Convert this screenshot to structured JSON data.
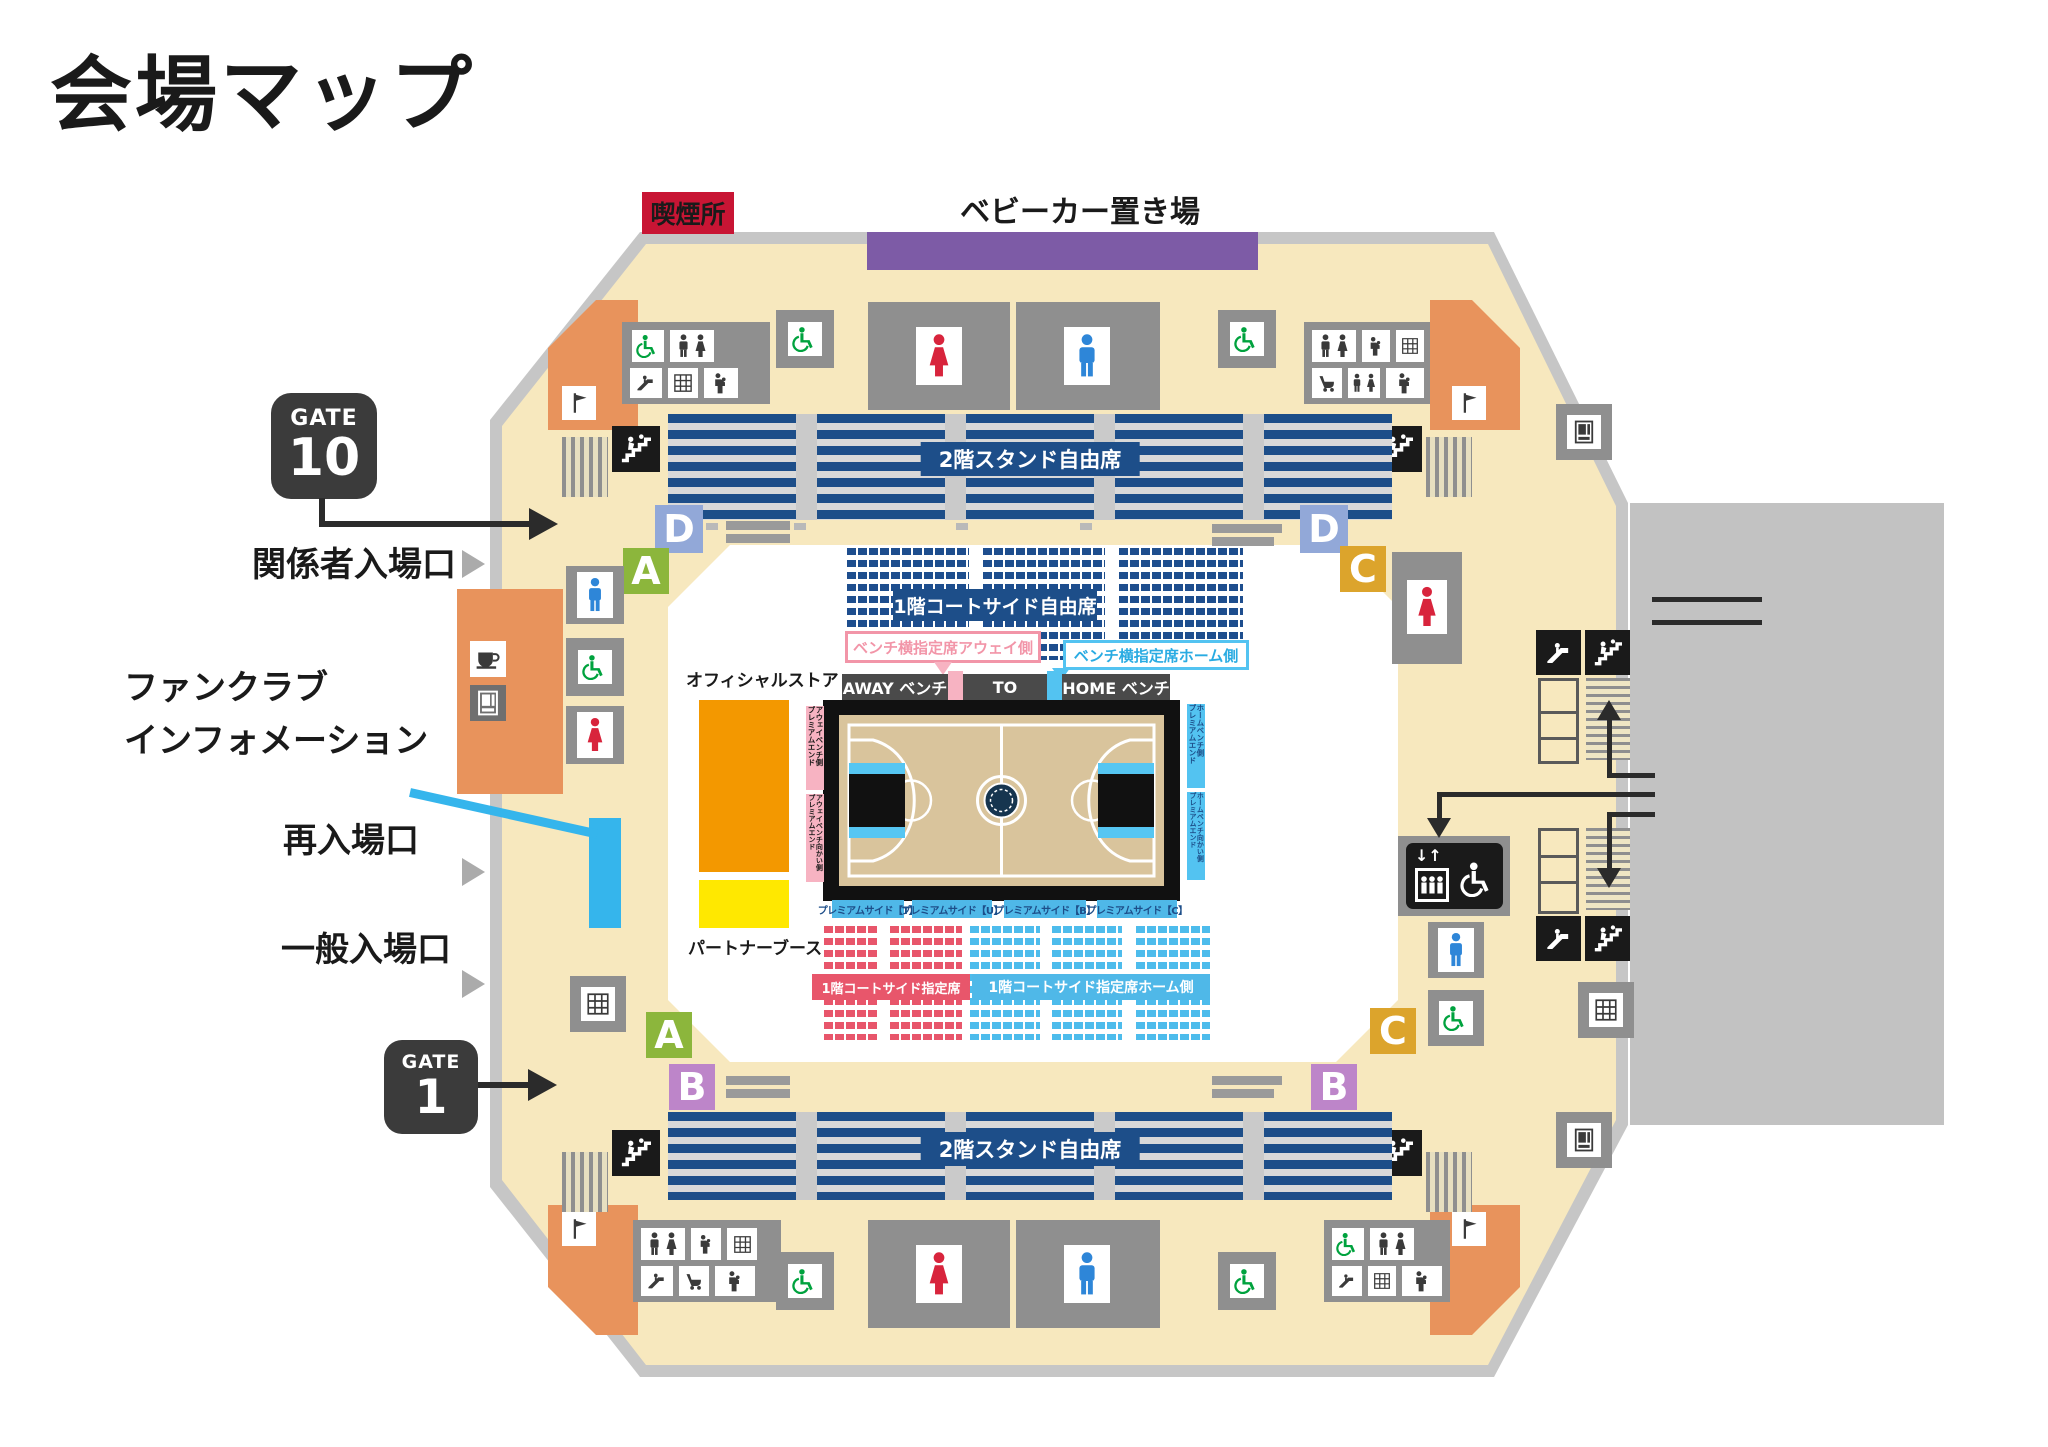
{
  "title": "会場マップ",
  "top": {
    "smoking": "喫煙所",
    "stroller": "ベビーカー置き場"
  },
  "gates": {
    "g10_prefix": "GATE",
    "g10_number": "10",
    "g1_prefix": "GATE",
    "g1_number": "1"
  },
  "entrances": {
    "staff": "関係者入場口",
    "fanclub_l1": "ファンクラブ",
    "fanclub_l2": "インフォメーション",
    "reentry": "再入場口",
    "general": "一般入場口"
  },
  "stands": {
    "stand_2f": "2階スタンド自由席",
    "courtside_free": "1階コートサイド自由席",
    "courtside_reserved": "1階コートサイド指定席",
    "courtside_reserved_home": "1階コートサイド指定席ホーム側"
  },
  "bench": {
    "away": "AWAY ベンチ",
    "to": "TO",
    "home": "HOME ベンチ",
    "callout_away": "ベンチ横指定席アウェイ側",
    "callout_home": "ベンチ横指定席ホーム側"
  },
  "premium": {
    "t": "プレミアムサイド【T】",
    "u": "プレミアムサイド【U】",
    "b": "プレミアムサイド【B】",
    "c": "プレミアムサイド【C】",
    "away_l1": "アウェイベンチ側",
    "away_l2": "プレミアムエンド",
    "away_op_l1": "アウェイベンチ向かい側",
    "away_op_l2": "プレミアムエンド",
    "home_l1": "ホームベンチ側",
    "home_l2": "プレミアムエンド",
    "home_op_l1": "ホームベンチ向かい側",
    "home_op_l2": "プレミアムエンド"
  },
  "shops": {
    "official": "オフィシャルストア",
    "partner": "パートナーブース"
  },
  "sections": {
    "a": "A",
    "b": "B",
    "c": "C",
    "d": "D"
  },
  "elevator": {
    "arrows": "↓↑"
  },
  "colors": {
    "navy_seat": "#1d4e89",
    "red_seat": "#e8566b",
    "light_blue_seat": "#4dbcec",
    "pink_strip": "#f7b3c2",
    "cyan_strip": "#53c3f1",
    "cream_concourse": "#f7e8be",
    "gray_band": "#c6c6c6",
    "gray_block": "#8f8f8f",
    "orange_store": "#f39800",
    "yellow_booth": "#ffe800",
    "orange_block": "#e8935c",
    "purple_stroller": "#7d5ba6",
    "crimson_smoking": "#c81534",
    "gate_dark": "#3b3b3b",
    "section_a_green": "#8cb63c",
    "section_b_violet": "#bd85c9",
    "section_c_amber": "#dca42c",
    "section_d_blue": "#92a8d8",
    "fanclub_blue": "#35b5ec",
    "court_floor": "#d9c49c"
  },
  "icons": [
    "toilet-male-icon",
    "toilet-female-icon",
    "restroom-icon",
    "accessible-icon",
    "stairs-icon",
    "escalator-icon",
    "elevator-icon",
    "coin-locker-icon",
    "vending-machine-icon",
    "cafe-icon",
    "baby-room-icon",
    "stroller-icon",
    "shop-icon",
    "smoking-area-badge",
    "stroller-area-bar"
  ]
}
